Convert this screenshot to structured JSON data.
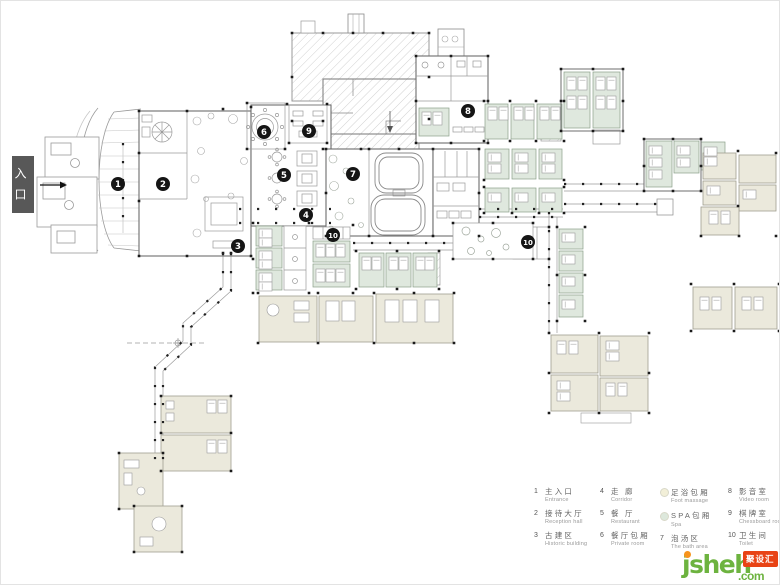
{
  "entrance": {
    "label": "入口"
  },
  "plan": {
    "markers": [
      {
        "n": "1",
        "x": 117,
        "y": 183
      },
      {
        "n": "2",
        "x": 162,
        "y": 183
      },
      {
        "n": "3",
        "x": 237,
        "y": 245
      },
      {
        "n": "4",
        "x": 305,
        "y": 214
      },
      {
        "n": "5",
        "x": 283,
        "y": 174
      },
      {
        "n": "6",
        "x": 263,
        "y": 131
      },
      {
        "n": "7",
        "x": 352,
        "y": 173
      },
      {
        "n": "8",
        "x": 467,
        "y": 110
      },
      {
        "n": "9",
        "x": 308,
        "y": 130
      },
      {
        "n": "10",
        "x": 332,
        "y": 234
      },
      {
        "n": "10",
        "x": 527,
        "y": 241
      }
    ]
  },
  "legend": {
    "columns": [
      {
        "items": [
          {
            "num": "1",
            "zh": "主入口",
            "en": "Entrance"
          },
          {
            "num": "2",
            "zh": "接待大厅",
            "en": "Reception hall"
          },
          {
            "num": "3",
            "zh": "古建区",
            "en": "Historic building"
          }
        ]
      },
      {
        "items": [
          {
            "num": "4",
            "zh": "走 廊",
            "en": "Corridor"
          },
          {
            "num": "5",
            "zh": "餐 厅",
            "en": "Restaurant"
          },
          {
            "num": "6",
            "zh": "餐厅包厢",
            "en": "Private room"
          }
        ]
      },
      {
        "items": [
          {
            "swatch": "#f2efd8",
            "zh": "足浴包厢",
            "en": "Foot massage"
          },
          {
            "swatch": "#dde8dc",
            "zh": "SPA包厢",
            "en": "Spa"
          },
          {
            "num": "7",
            "zh": "泡汤区",
            "en": "The bath area"
          }
        ]
      },
      {
        "items": [
          {
            "num": "8",
            "zh": "影音室",
            "en": "Video room"
          },
          {
            "num": "9",
            "zh": "棋牌室",
            "en": "Chessboard room"
          },
          {
            "num": "10",
            "zh": "卫生间",
            "en": "Toilet"
          }
        ]
      }
    ]
  },
  "watermark": {
    "brand": "jsheh",
    "tld": ".com",
    "stamp": "聚设汇"
  },
  "colors": {
    "spa_room": "#dfe8de",
    "foot_room": "#ebe9dc",
    "marker": "#151515",
    "entrance_bg": "#585858",
    "logo_green": "#6db33f",
    "logo_orange": "#f7941d",
    "stamp_red": "#e84315"
  }
}
